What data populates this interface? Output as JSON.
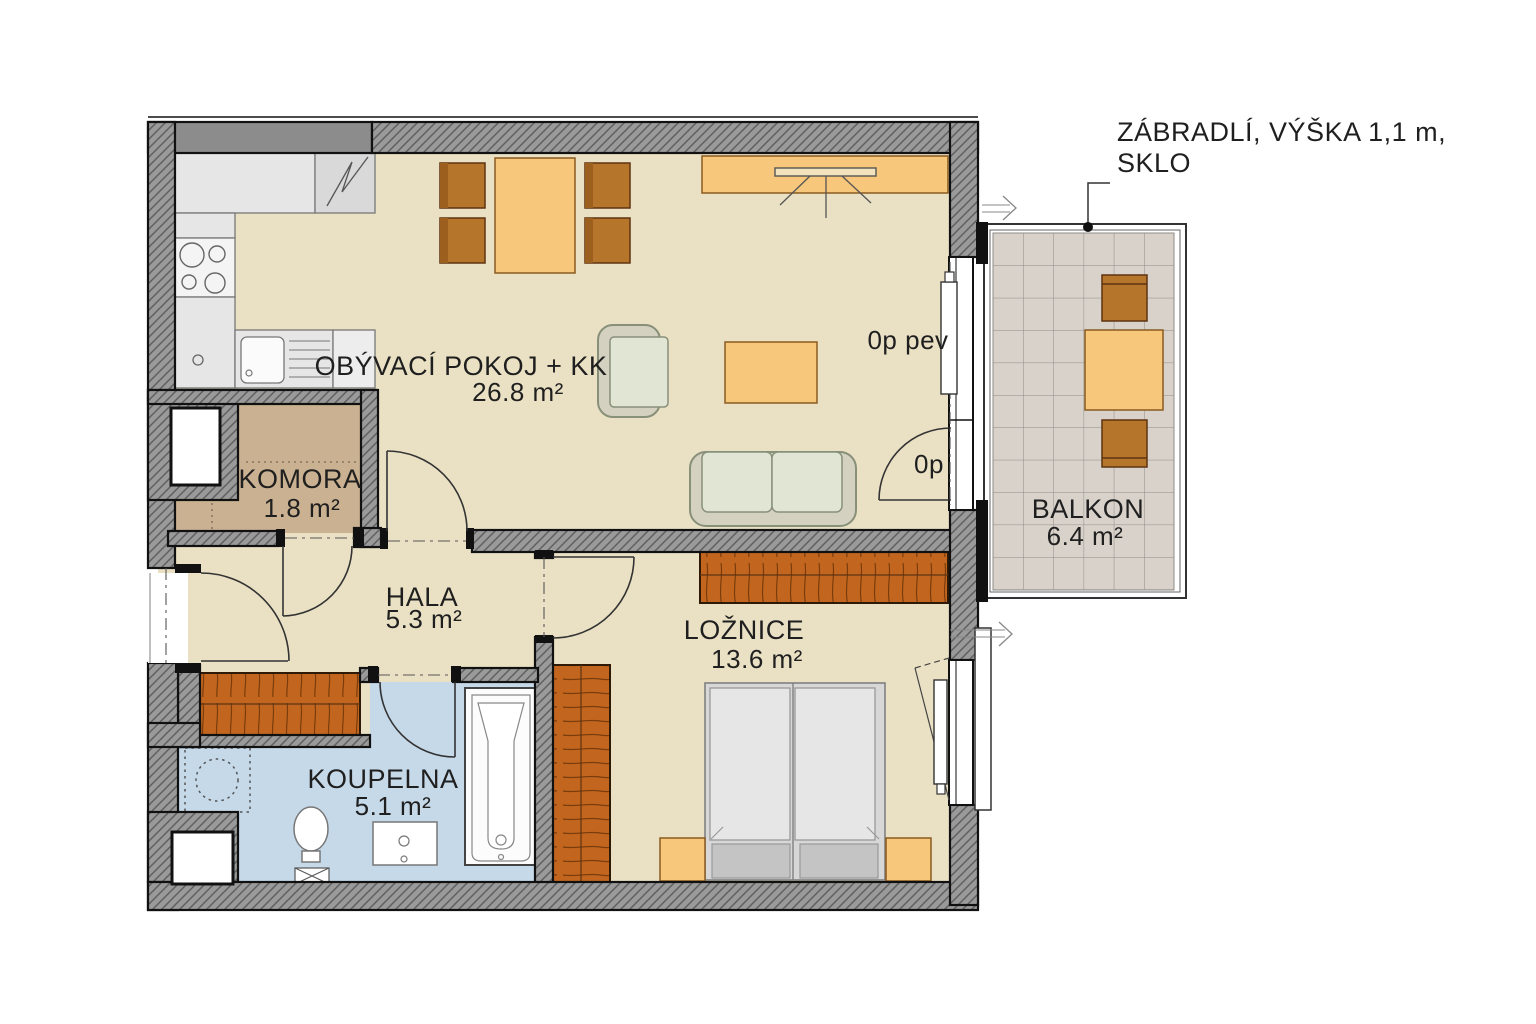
{
  "rooms": [
    {
      "id": "living",
      "name": "OBÝVACÍ POKOJ + KK",
      "area": "26.8 m²"
    },
    {
      "id": "komora",
      "name": "KOMORA",
      "area": "1.8 m²"
    },
    {
      "id": "hala",
      "name": "HALA",
      "area": "5.3 m²"
    },
    {
      "id": "koupelna",
      "name": "KOUPELNA",
      "area": "5.1 m²"
    },
    {
      "id": "loznice",
      "name": "LOŽNICE",
      "area": "13.6 m²"
    },
    {
      "id": "balkon",
      "name": "BALKON",
      "area": "6.4 m²"
    }
  ],
  "labels": {
    "window_fixed": "0p pev",
    "balcony_door": "0p"
  },
  "annotation": {
    "line1": "ZÁBRADLÍ, VÝŠKA 1,1 m,",
    "line2": "SKLO"
  },
  "colors": {
    "floor": "#eae1c4",
    "komora": "#cab191",
    "bath": "#c6d9e9",
    "balcony": "#d8d2cb",
    "wall": "#9a9a9a",
    "wallsolid": "#8c8c8c",
    "wood": "#b5762b",
    "lightwood": "#f7c77c",
    "wardrobe": "#c2661f",
    "sofa": "#d4d1c0",
    "cushion": "#e0e5d4",
    "mattress": "#e6e6e6",
    "pillow": "#c4c4c4",
    "counter": "#e6e6e6"
  }
}
